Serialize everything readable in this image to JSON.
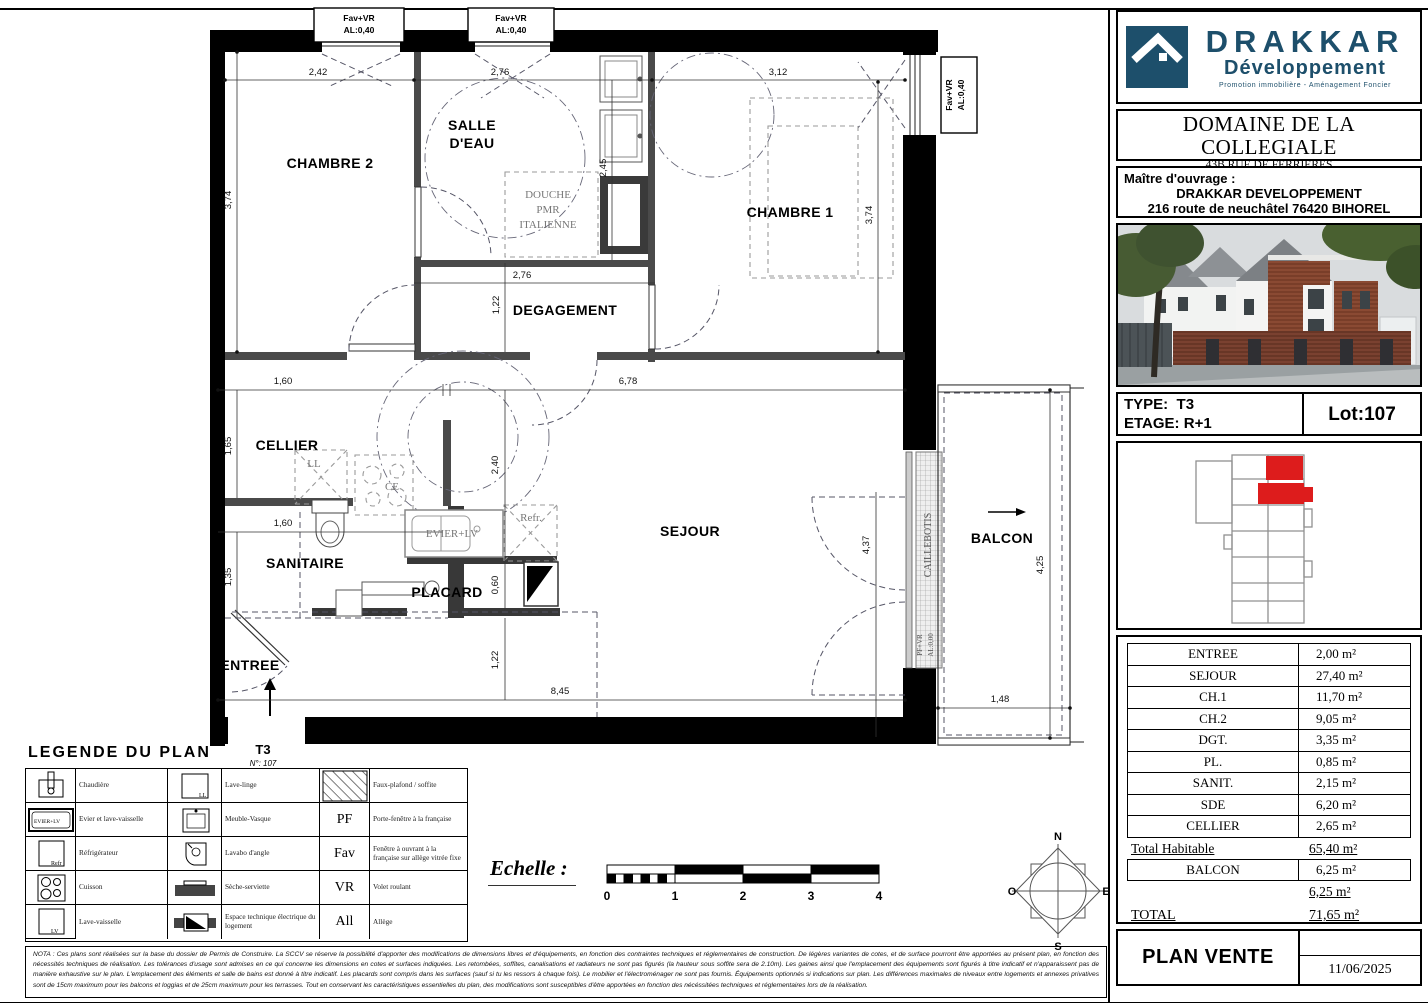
{
  "colors": {
    "brand_navy": "#1d4f6b",
    "highlight_red": "#dd1c1c"
  },
  "plan": {
    "labels": {
      "chambre2": "CHAMBRE 2",
      "salle_eau_1": "SALLE",
      "salle_eau_2": "D'EAU",
      "chambre1": "CHAMBRE 1",
      "degagement": "DEGAGEMENT",
      "cellier": "CELLIER",
      "sanitaire": "SANITAIRE",
      "placard": "PLACARD",
      "sejour": "SEJOUR",
      "entree": "ENTREE",
      "balcon": "BALCON",
      "douche_1": "DOUCHE",
      "douche_2": "PMR",
      "douche_3": "ITALIENNE",
      "ll": "LL",
      "ce": "CE",
      "evier": "EVIER+LV",
      "refr": "Refr.",
      "caillebotis": "CAILLEBOTIS",
      "pf_vr": "PF+VR",
      "al000": "AL:0,00",
      "window_line1": "Fav+VR",
      "window_line2": "AL:0,40",
      "unit_type": "T3",
      "unit_no": "N°: 107"
    },
    "dims": {
      "d242": "2,42",
      "d276a": "2,76",
      "d312": "3,12",
      "d374l": "3,74",
      "d245": "2,45",
      "d374r": "3,74",
      "d276b": "2,76",
      "d122a": "1,22",
      "d160a": "1,60",
      "d678": "6,78",
      "d165": "1,65",
      "d160b": "1,60",
      "d135": "1,35",
      "d240": "2,40",
      "d060": "0,60",
      "d437": "4,37",
      "d122b": "1,22",
      "d845": "8,45",
      "d425": "4,25",
      "d148": "1,48"
    }
  },
  "legend": {
    "title": "LEGENDE DU PLAN",
    "icon_texts": {
      "ll": "LL",
      "refr": "Refr",
      "lv": "LV",
      "evier": "EVIER+LV"
    },
    "rows": [
      {
        "label1": "Chaudière",
        "label2": "Lave-linge",
        "sym": "",
        "label3": "Faux-plafond / soffite"
      },
      {
        "label1": "Evier et lave-vaisselle",
        "label2": "Meuble-Vasque",
        "sym": "PF",
        "label3": "Porte-fenêtre à la française"
      },
      {
        "label1": "Réfrigérateur",
        "label2": "Lavabo d'angle",
        "sym": "Fav",
        "label3": "Fenêtre à ouvrant à la française sur allège vitrée fixe"
      },
      {
        "label1": "Cuisson",
        "label2": "Sèche-serviette",
        "sym": "VR",
        "label3": "Volet roulant"
      },
      {
        "label1": "Lave-vaisselle",
        "label2": "Espace technique électrique du logement",
        "sym": "All",
        "label3": "Allège"
      }
    ]
  },
  "scale": {
    "title": "Echelle :",
    "ticks": [
      "0",
      "1",
      "2",
      "3",
      "4"
    ]
  },
  "compass": {
    "n": "N",
    "s": "S",
    "o": "O",
    "e": "E"
  },
  "nota": {
    "text": "NOTA : Ces plans sont réalisées sur la base du dossier de Permis de Construire. La SCCV se réserve la possibilité d'apporter des modifications de dimensions libres et d'équipements, en fonction des contraintes techniques et réglementaires de construction. De légères variantes de cotes, et de surface pourront être apportées au présent plan, en fonction des nécessités techniques de réalisation. Les tolérances d'usage sont admises en ce qui concerne les dimensions en cotes et surfaces indiquées. Les retombées, soffites, canalisations et radiateurs ne sont pas figurés (la hauteur sous soffite sera de 2.10m). Les gaines ainsi que l'emplacement des équipements sont figurés à titre indicatif et n'apparaissent pas de manière exhaustive sur le plan. L'emplacement des éléments et salle de bains est donné à titre indicatif. Les placards sont compris dans les surfaces (sauf si tu les ressors à chaque fois). Le mobilier et l'électroménager ne sont pas fournis. Équipements optionnés si indications sur plan. Les différences maximales de niveaux entre logements et annexes privatives sont de 15cm maximum pour les balcons et loggias et de 25cm maximum pour les terrasses. Tout en conservant les caractéristiques essentielles du plan, des modifications sont susceptibles d'être apportées en fonction des nécéssitées techniques et réglementaires lors de la réalisation."
  },
  "titleblock": {
    "logo": {
      "name": "DRAKKAR",
      "sub": "Développement",
      "tagline": "Promotion immobilière - Aménagement Foncier"
    },
    "project": {
      "name": "DOMAINE DE LA COLLEGIALE",
      "address1": "43B RUE DE FERRIERES",
      "address2": "GOURNAY EN BRAY"
    },
    "owner": {
      "label": "Maître d'ouvrage :",
      "name": "DRAKKAR DEVELOPPEMENT",
      "address": "216 route de neuchâtel 76420 BIHOREL"
    },
    "unit": {
      "type_label": "TYPE:",
      "type_value": "T3",
      "floor_label": "ETAGE:",
      "floor_value": "R+1",
      "lot": "Lot:107"
    },
    "areas": {
      "rows": [
        {
          "label": "ENTREE",
          "value": "2,00 m²"
        },
        {
          "label": "SEJOUR",
          "value": "27,40 m²"
        },
        {
          "label": "CH.1",
          "value": "11,70 m²"
        },
        {
          "label": "CH.2",
          "value": "9,05 m²"
        },
        {
          "label": "DGT.",
          "value": "3,35 m²"
        },
        {
          "label": "PL.",
          "value": "0,85 m²"
        },
        {
          "label": "SANIT.",
          "value": "2,15 m²"
        },
        {
          "label": "SDE",
          "value": "6,20 m²"
        },
        {
          "label": "CELLIER",
          "value": "2,65 m²"
        }
      ],
      "total_hab_label": "Total Habitable",
      "total_hab_value": "65,40 m²",
      "balcon_label": "BALCON",
      "balcon_value": "6,25 m²",
      "annex_total": "6,25 m²",
      "total_label": "TOTAL",
      "total_value": "71,65 m²"
    },
    "doc": {
      "title": "PLAN VENTE",
      "date": "11/06/2025"
    }
  }
}
